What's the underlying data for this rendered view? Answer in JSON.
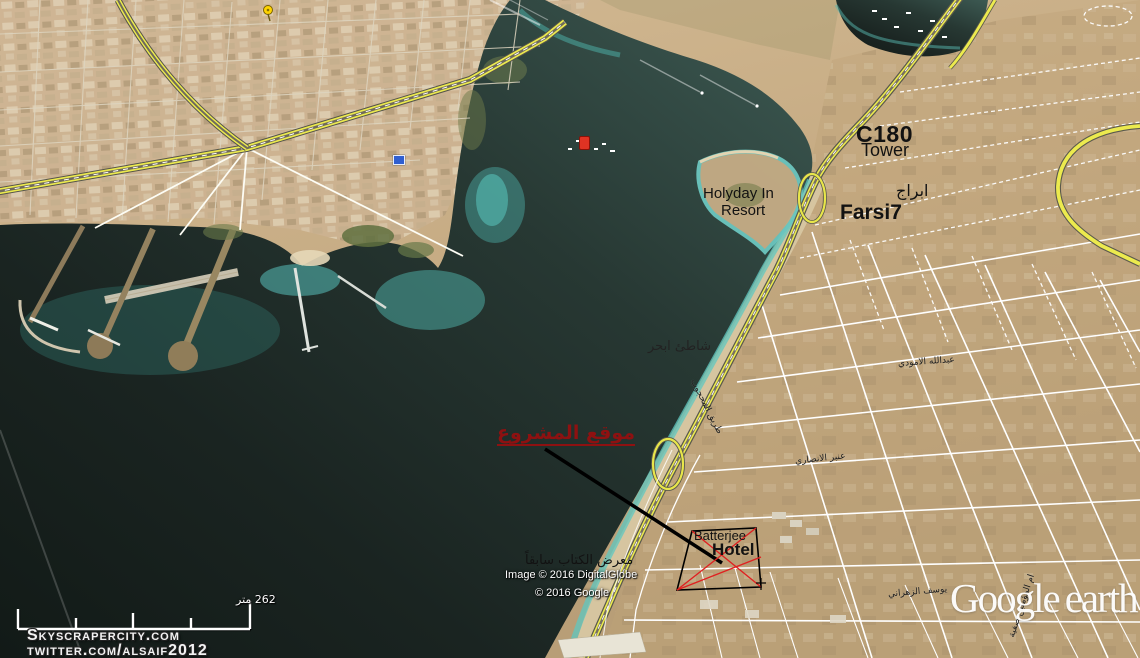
{
  "app": {
    "name": "Google Earth",
    "logo": {
      "word1": "Google",
      "word2": "earth"
    }
  },
  "annotations": {
    "c180_tower": {
      "line1": "C180",
      "line2": "Tower"
    },
    "farsi7": {
      "line1": "ابراج",
      "line2": "Farsi7"
    },
    "holyday_inn": {
      "line1": "Holyday In",
      "line2": "Resort"
    },
    "project_site": {
      "title": "موقع المشروع"
    },
    "batterjee_hotel": {
      "line1": "Batterjee",
      "line2": "Hotel"
    },
    "book_fair": {
      "label": "معرض الكتاب سابقاً"
    }
  },
  "map_labels": {
    "beach": "شاطئ ابحر",
    "street_amoudi": "عبدالله الامودي",
    "street_ansari": "عنبر الانصاري",
    "street_mahjoub": "طريق المحجوب",
    "street_safiya": "ام المؤمنين صفية",
    "street_zahrani": "يوسف الزهراني"
  },
  "scale_bar": {
    "label": "262 متر"
  },
  "attribution": {
    "imagery": "Image © 2016 DigitalGlobe",
    "copyright": "© 2016 Google"
  },
  "watermarks": {
    "site": "Skyscrapercity.com",
    "twitter": "twitter.com/alsaif2012"
  },
  "icons": {
    "pushpin": "yellow-pushpin-icon",
    "resort_marker": "blue-placemark-icon",
    "marina_marker": "red-marina-icon"
  },
  "colors": {
    "annotation_red": "#8e1111",
    "site_cross_red": "#e02020",
    "road_yellow": "#ecea4e",
    "water_deep": "#16201d",
    "land_tan": "#c6ab83"
  }
}
